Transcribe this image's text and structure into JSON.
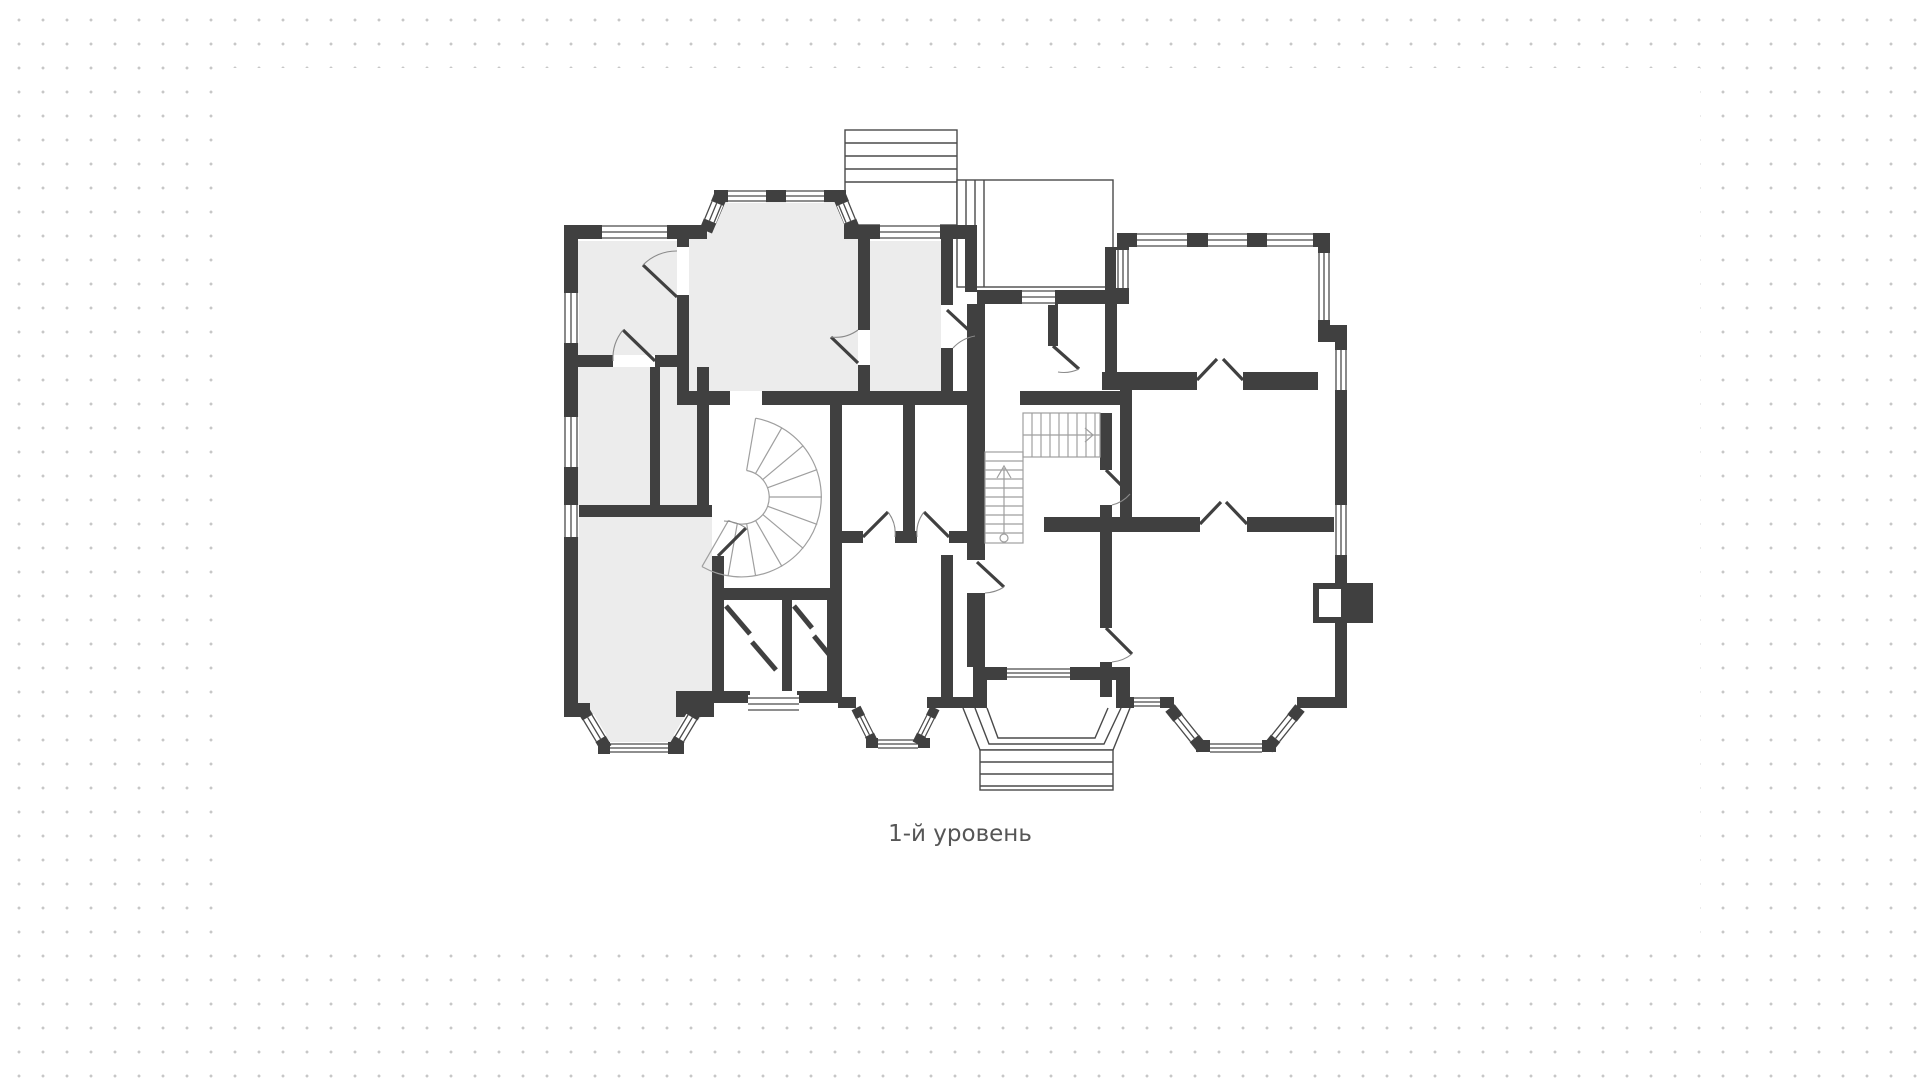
{
  "canvas": {
    "background_color": "#ffffff",
    "dot_color": "#c7c7c7",
    "sheet_color": "#ffffff"
  },
  "plan": {
    "caption": "1-й уровень",
    "colors": {
      "wall": "#404040",
      "room_fill": "#ececec",
      "thin_line": "#4a4a4a",
      "stair_line": "#9f9f9f",
      "caption": "#565656"
    },
    "features": [
      "exterior-staircase-top",
      "terrace-top",
      "arched-bay-window-top",
      "spiral-staircase",
      "l-shaped-staircase",
      "entrance-porch-with-steps",
      "bay-window-bottom-left",
      "bay-window-bottom-center",
      "bay-window-bottom-right",
      "fireplace-right-wall"
    ]
  }
}
